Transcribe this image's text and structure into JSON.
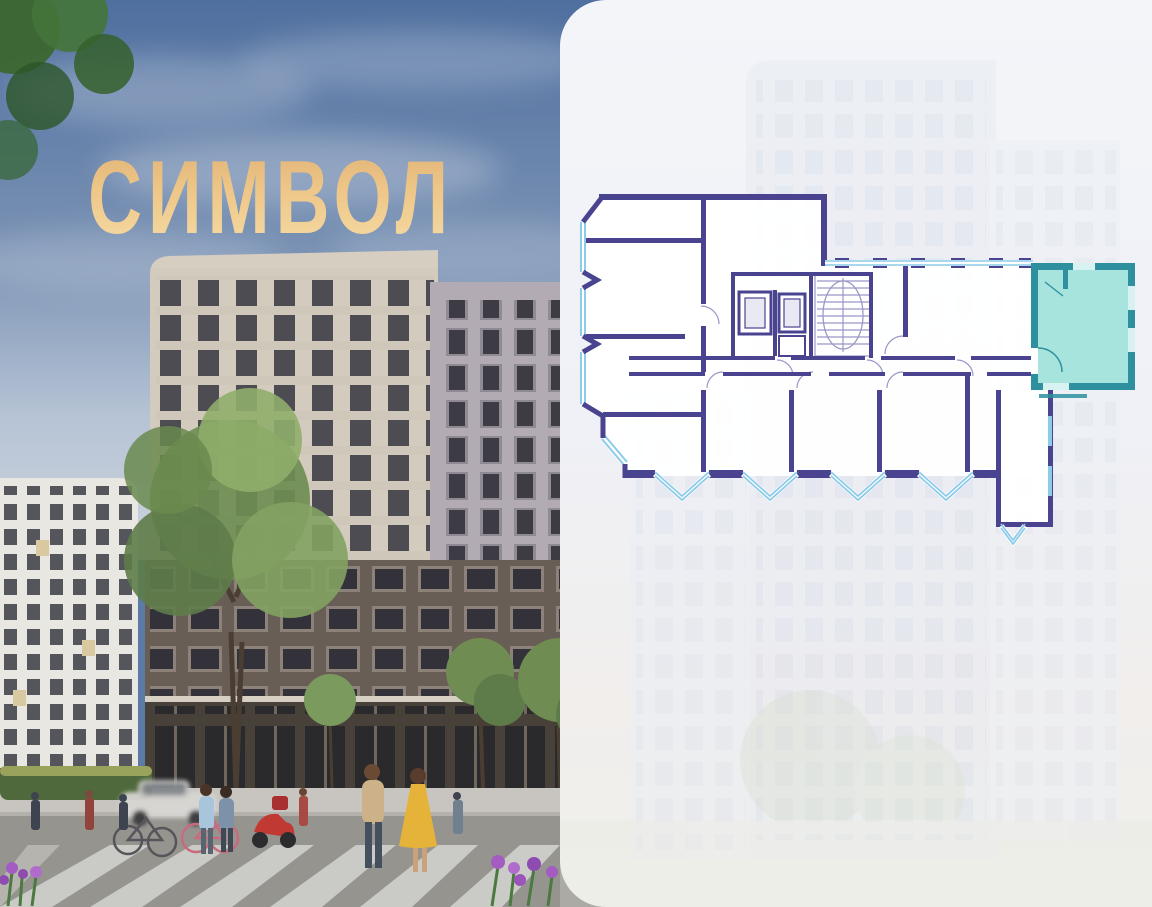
{
  "project": {
    "logo_text": "СИМВОЛ",
    "logo_color": "#e9c286"
  },
  "floorplan": {
    "wall_color": "#4a4490",
    "window_color": "#8ccbe9",
    "highlight_wall_color": "#2e8f9e",
    "highlight_fill_color": "#a6e4dd"
  },
  "info": {
    "value_color": "#4b4489",
    "items": [
      {
        "value": "(3А) 33",
        "label": "КОРПУС"
      },
      {
        "value": "2",
        "label": "СЕКЦИЯ"
      },
      {
        "value": "25",
        "label": "ЭТАЖ"
      }
    ]
  }
}
